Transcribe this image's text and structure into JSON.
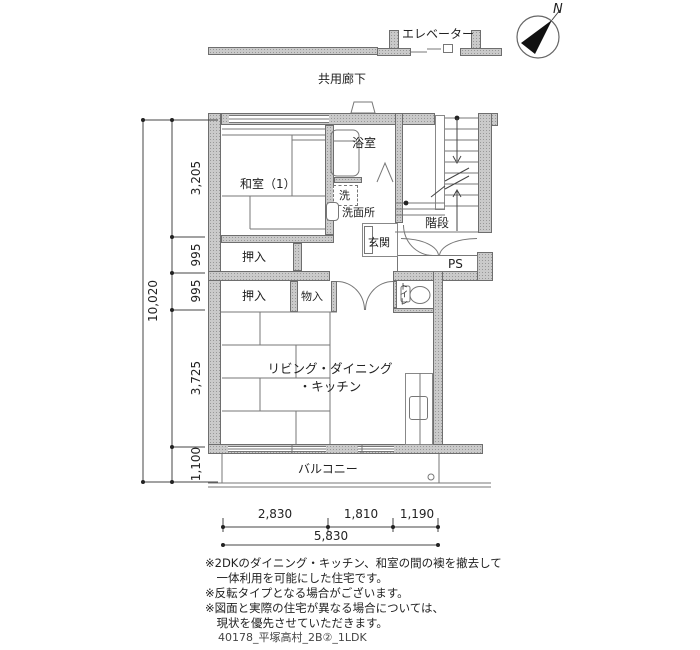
{
  "header": {
    "elevator": "エレベーター",
    "corridor": "共用廊下",
    "compass_n": "N"
  },
  "rooms": {
    "washitsu1": "和室（1）",
    "bath": "浴室",
    "washer": "洗",
    "washroom": "洗面所",
    "entrance": "玄関",
    "stairs": "階段",
    "pipe_space": "PS",
    "closet_upper": "押入",
    "closet_lower": "押入",
    "storage": "物入",
    "toilet": "トイレ",
    "ldk_line1": "リビング・ダイニング",
    "ldk_line2": "・キッチン",
    "balcony": "バルコニー"
  },
  "dimensions": {
    "bottom_segments": [
      "2,830",
      "1,810",
      "1,190"
    ],
    "bottom_total": "5,830",
    "left_segments": [
      "3,205",
      "995",
      "995",
      "3,725",
      "1,100"
    ],
    "left_total": "10,020"
  },
  "notes": [
    "※2DKのダイニング・キッチン、和室の間の襖を撤去して",
    "　一体利用を可能にした住宅です。",
    "※反転タイプとなる場合がございます。",
    "※図面と実際の住宅が異なる場合については、",
    "　現状を優先させていただきます。"
  ],
  "plan_id": "40178_平塚高村_2B②_1LDK",
  "colors": {
    "wall_line": "#6e6e6e",
    "thin_line": "#777777",
    "text": "#222222"
  }
}
